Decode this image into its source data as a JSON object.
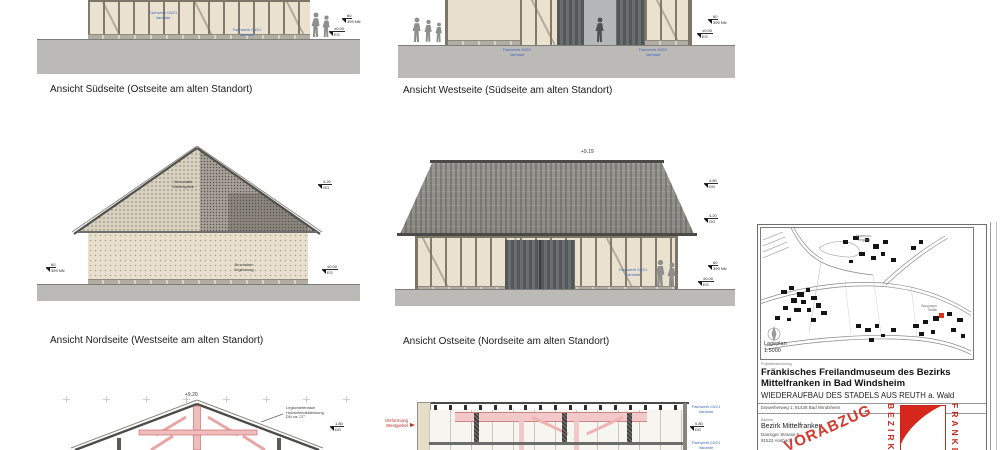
{
  "labels": {
    "view_south": "Ansicht Südseite (Ostseite am alten Standort)",
    "view_west": "Ansicht Westseite (Südseite am alten Standort)",
    "view_north": "Ansicht Nordseite (Westseite am alten Standort)",
    "view_east": "Ansicht Ostseite (Nordseite am alten Standort)"
  },
  "markers": {
    "dg": {
      "value": "4.80",
      "level": "DG"
    },
    "og": {
      "value": "4.20",
      "level": "OG"
    },
    "eg": {
      "value": "±0.00",
      "level": "EG"
    },
    "nn": {
      "value": "60",
      "level": "399 NN"
    },
    "dg_e": {
      "value": "1.80",
      "level": "DG"
    },
    "dg_f": {
      "value": "0.80",
      "level": "DG"
    }
  },
  "annotations": {
    "peak_east": "+9.19",
    "peak_section": "+9.20",
    "gable_note": [
      "Verschalte",
      "Giebelspitze"
    ],
    "masonry_note": [
      "Bruchstein",
      "Ergänzung"
    ],
    "roof_note": [
      "Legschieferdach",
      "Holzschindeldeckung",
      "DN ca. 27°"
    ],
    "deform_note": [
      "Verformung",
      "Westgiebel"
    ],
    "blue_tag": [
      "Fachwerk 03/21",
      "Variante"
    ]
  },
  "titleblock": {
    "map": {
      "caption_name": "Lageplan",
      "caption_scale": "1:5000",
      "label_entrance": [
        "Museums-",
        "eingang"
      ],
      "label_site": [
        "Baugruppe",
        "Stadel"
      ]
    },
    "project_label": "Projektbezeichnung",
    "title_line1": "Fränkisches Freilandmuseum des Bezirks",
    "title_line2": "Mittelfranken in Bad Windsheim",
    "subtitle": "WIEDERAUFBAU DES STADELS AUS REUTH a. Wald",
    "address": "Eisweiherweg 1, 91438 Bad Windsheim",
    "client_label": "Bauherr",
    "client_name": "Bezirk Mittelfranken",
    "client_street": "Danziger Strasse 5",
    "client_city": "91522 Ansbach",
    "stamp": "VORABZUG",
    "logo": {
      "left": "BEZIRK",
      "right": "FRANKEN"
    }
  },
  "colors": {
    "accent_red": "#cc2222",
    "annotation_blue": "#3f68c0",
    "ground_gray": "#bcbab7",
    "roof_gray": "#94928c",
    "timber_brown": "#7d7567",
    "infill_beige": "#eae2cf",
    "stamp_red": "#d23a2e"
  }
}
